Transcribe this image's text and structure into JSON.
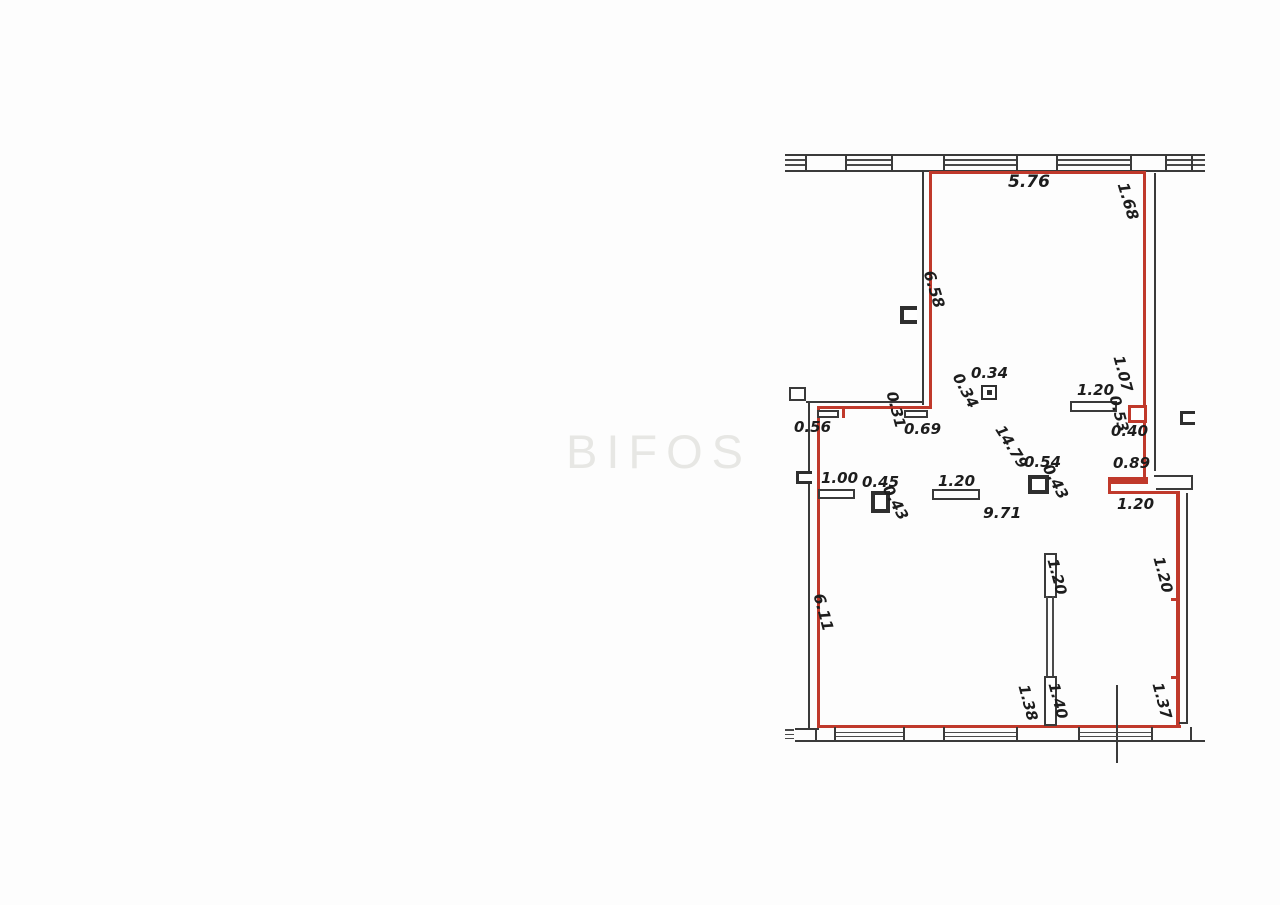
{
  "meta": {
    "type": "floor-plan",
    "outline_color": "#c0392b",
    "wall_color": "#3a3a3a",
    "background_color": "#fdfdfd"
  },
  "watermark": {
    "text": "BIFOS",
    "color": "#e7e7e4"
  },
  "dimensions": {
    "top_width": "5.76",
    "interior_area_labels": [
      "14.79",
      "9.71"
    ],
    "left_heights": [
      "6.58",
      "6.11"
    ]
  },
  "labels": [
    {
      "text": "5.76",
      "x": 1008,
      "y": 174,
      "rot": 0,
      "size": 17
    },
    {
      "text": "1.68",
      "x": 1129,
      "y": 181,
      "rot": 73,
      "size": 15.5
    },
    {
      "text": "6.58",
      "x": 935,
      "y": 269,
      "rot": 73,
      "size": 15.5
    },
    {
      "text": "0.34",
      "x": 971,
      "y": 366,
      "rot": 0,
      "size": 15
    },
    {
      "text": "0.34",
      "x": 963,
      "y": 371,
      "rot": 62,
      "size": 15
    },
    {
      "text": "1.20",
      "x": 1077,
      "y": 383,
      "rot": 0,
      "size": 15
    },
    {
      "text": "1.07",
      "x": 1125,
      "y": 354,
      "rot": 75,
      "size": 15
    },
    {
      "text": "0.53",
      "x": 1121,
      "y": 394,
      "rot": 75,
      "size": 15
    },
    {
      "text": "0.40",
      "x": 1111,
      "y": 424,
      "rot": 0,
      "size": 15
    },
    {
      "text": "0.56",
      "x": 794,
      "y": 420,
      "rot": 0,
      "size": 15
    },
    {
      "text": "0.31",
      "x": 898,
      "y": 390,
      "rot": 75,
      "size": 15
    },
    {
      "text": "0.69",
      "x": 904,
      "y": 422,
      "rot": 0,
      "size": 15
    },
    {
      "text": "14.79",
      "x": 1005,
      "y": 423,
      "rot": 58,
      "size": 15
    },
    {
      "text": "0.54",
      "x": 1024,
      "y": 455,
      "rot": 0,
      "size": 15
    },
    {
      "text": "0.43",
      "x": 1053,
      "y": 462,
      "rot": 62,
      "size": 15
    },
    {
      "text": "0.89",
      "x": 1113,
      "y": 456,
      "rot": 0,
      "size": 15
    },
    {
      "text": "1.00",
      "x": 821,
      "y": 471,
      "rot": 0,
      "size": 15
    },
    {
      "text": "0.45",
      "x": 862,
      "y": 475,
      "rot": 0,
      "size": 15
    },
    {
      "text": "0.43",
      "x": 893,
      "y": 483,
      "rot": 62,
      "size": 15
    },
    {
      "text": "1.20",
      "x": 938,
      "y": 474,
      "rot": 0,
      "size": 15
    },
    {
      "text": "9.71",
      "x": 983,
      "y": 506,
      "rot": 0,
      "size": 15.5
    },
    {
      "text": "1.20",
      "x": 1117,
      "y": 497,
      "rot": 0,
      "size": 15
    },
    {
      "text": "6.11",
      "x": 825,
      "y": 592,
      "rot": 75,
      "size": 15.5
    },
    {
      "text": "1.20",
      "x": 1059,
      "y": 557,
      "rot": 75,
      "size": 15
    },
    {
      "text": "1.20",
      "x": 1165,
      "y": 555,
      "rot": 75,
      "size": 15
    },
    {
      "text": "1.38",
      "x": 1030,
      "y": 683,
      "rot": 75,
      "size": 15
    },
    {
      "text": "1.40",
      "x": 1060,
      "y": 681,
      "rot": 75,
      "size": 15
    },
    {
      "text": "1.37",
      "x": 1164,
      "y": 681,
      "rot": 75,
      "size": 15
    }
  ]
}
